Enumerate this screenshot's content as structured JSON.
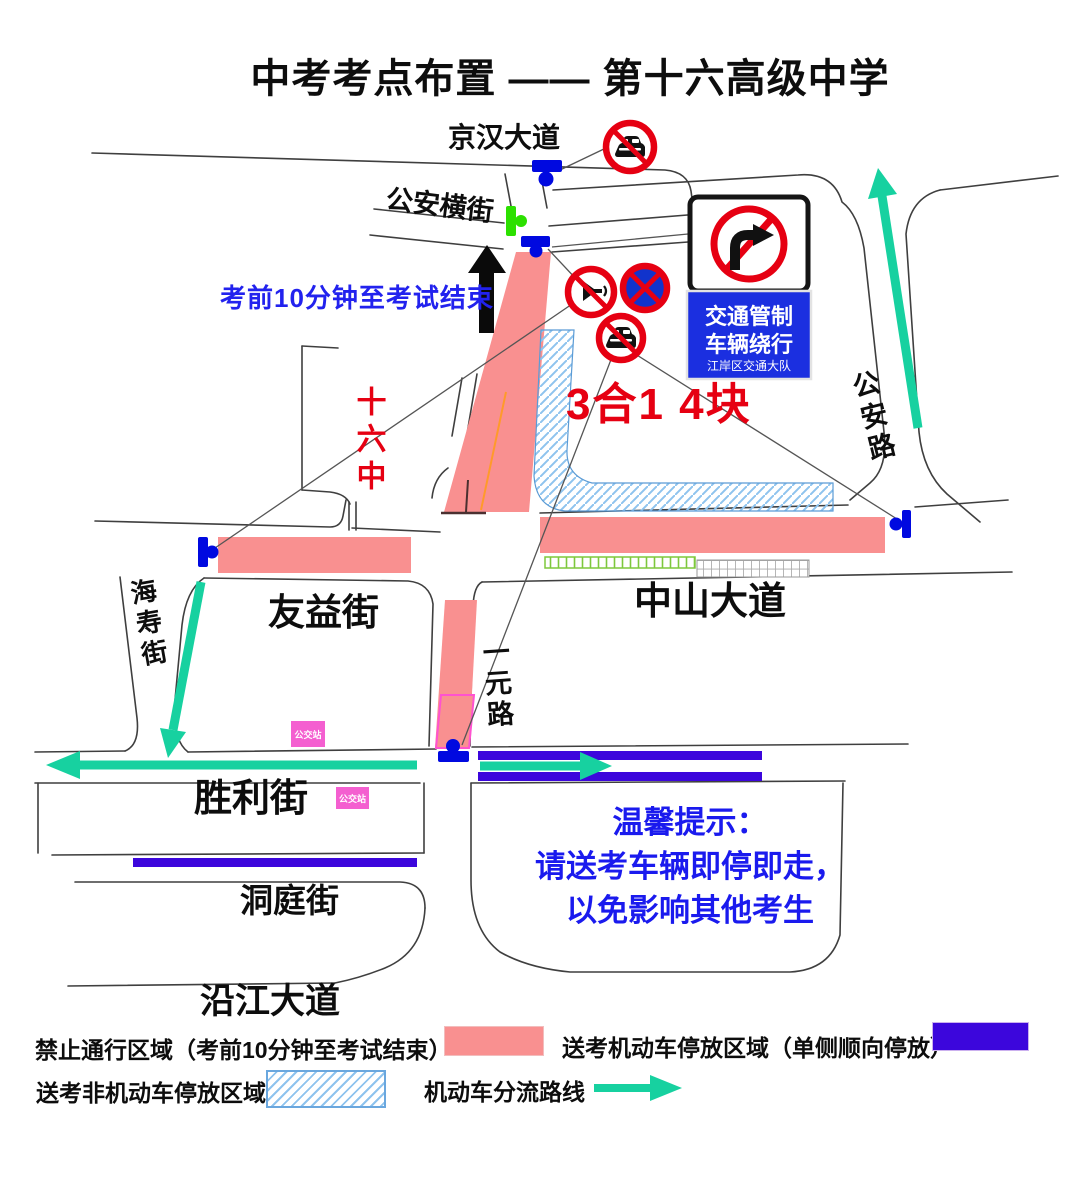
{
  "title": "中考考点布置 —— 第十六高级中学",
  "roads": {
    "jinghan_avenue": "京汉大道",
    "gongan_side_street": "公安横街",
    "gongan_road": "公安路",
    "haishou_street": "海寿街",
    "youyi_street": "友益街",
    "zhongshan_avenue": "中山大道",
    "yiyuan_road": "一元路",
    "shengli_street": "胜利街",
    "dongting_street": "洞庭街",
    "yanjiang_avenue": "沿江大道"
  },
  "annotations": {
    "restriction_period": "考前10分钟至考试结束",
    "school_name": "十六中",
    "sign_note": "3合1 4块",
    "bus_stop": "公交站"
  },
  "detour_sign": {
    "line1": "交通管制",
    "line2": "车辆绕行",
    "line3": "江岸区交通大队"
  },
  "notice": {
    "title": "温馨提示：",
    "line1": "请送考车辆即停即走，",
    "line2": "以免影响其他考生"
  },
  "legend": {
    "no_pass": "禁止通行区域（考前10分钟至考试结束）",
    "motor_parking": "送考机动车停放区域（单侧顺向停放）",
    "non_motor_parking": "送考非机动车停放区域",
    "diversion_route": "机动车分流路线"
  },
  "colors": {
    "no_pass_zone": "#f99090",
    "motor_parking_zone": "#3c06dc",
    "non_motor_hatch": "#8ec3ee",
    "diversion_arrow": "#17d1a0",
    "traffic_light_blue": "#0009e0",
    "traffic_light_green": "#2ce000",
    "prohibition_red": "#e60012",
    "notice_blue": "#1a1aee",
    "bus_stop_pink": "#f45fd0"
  }
}
